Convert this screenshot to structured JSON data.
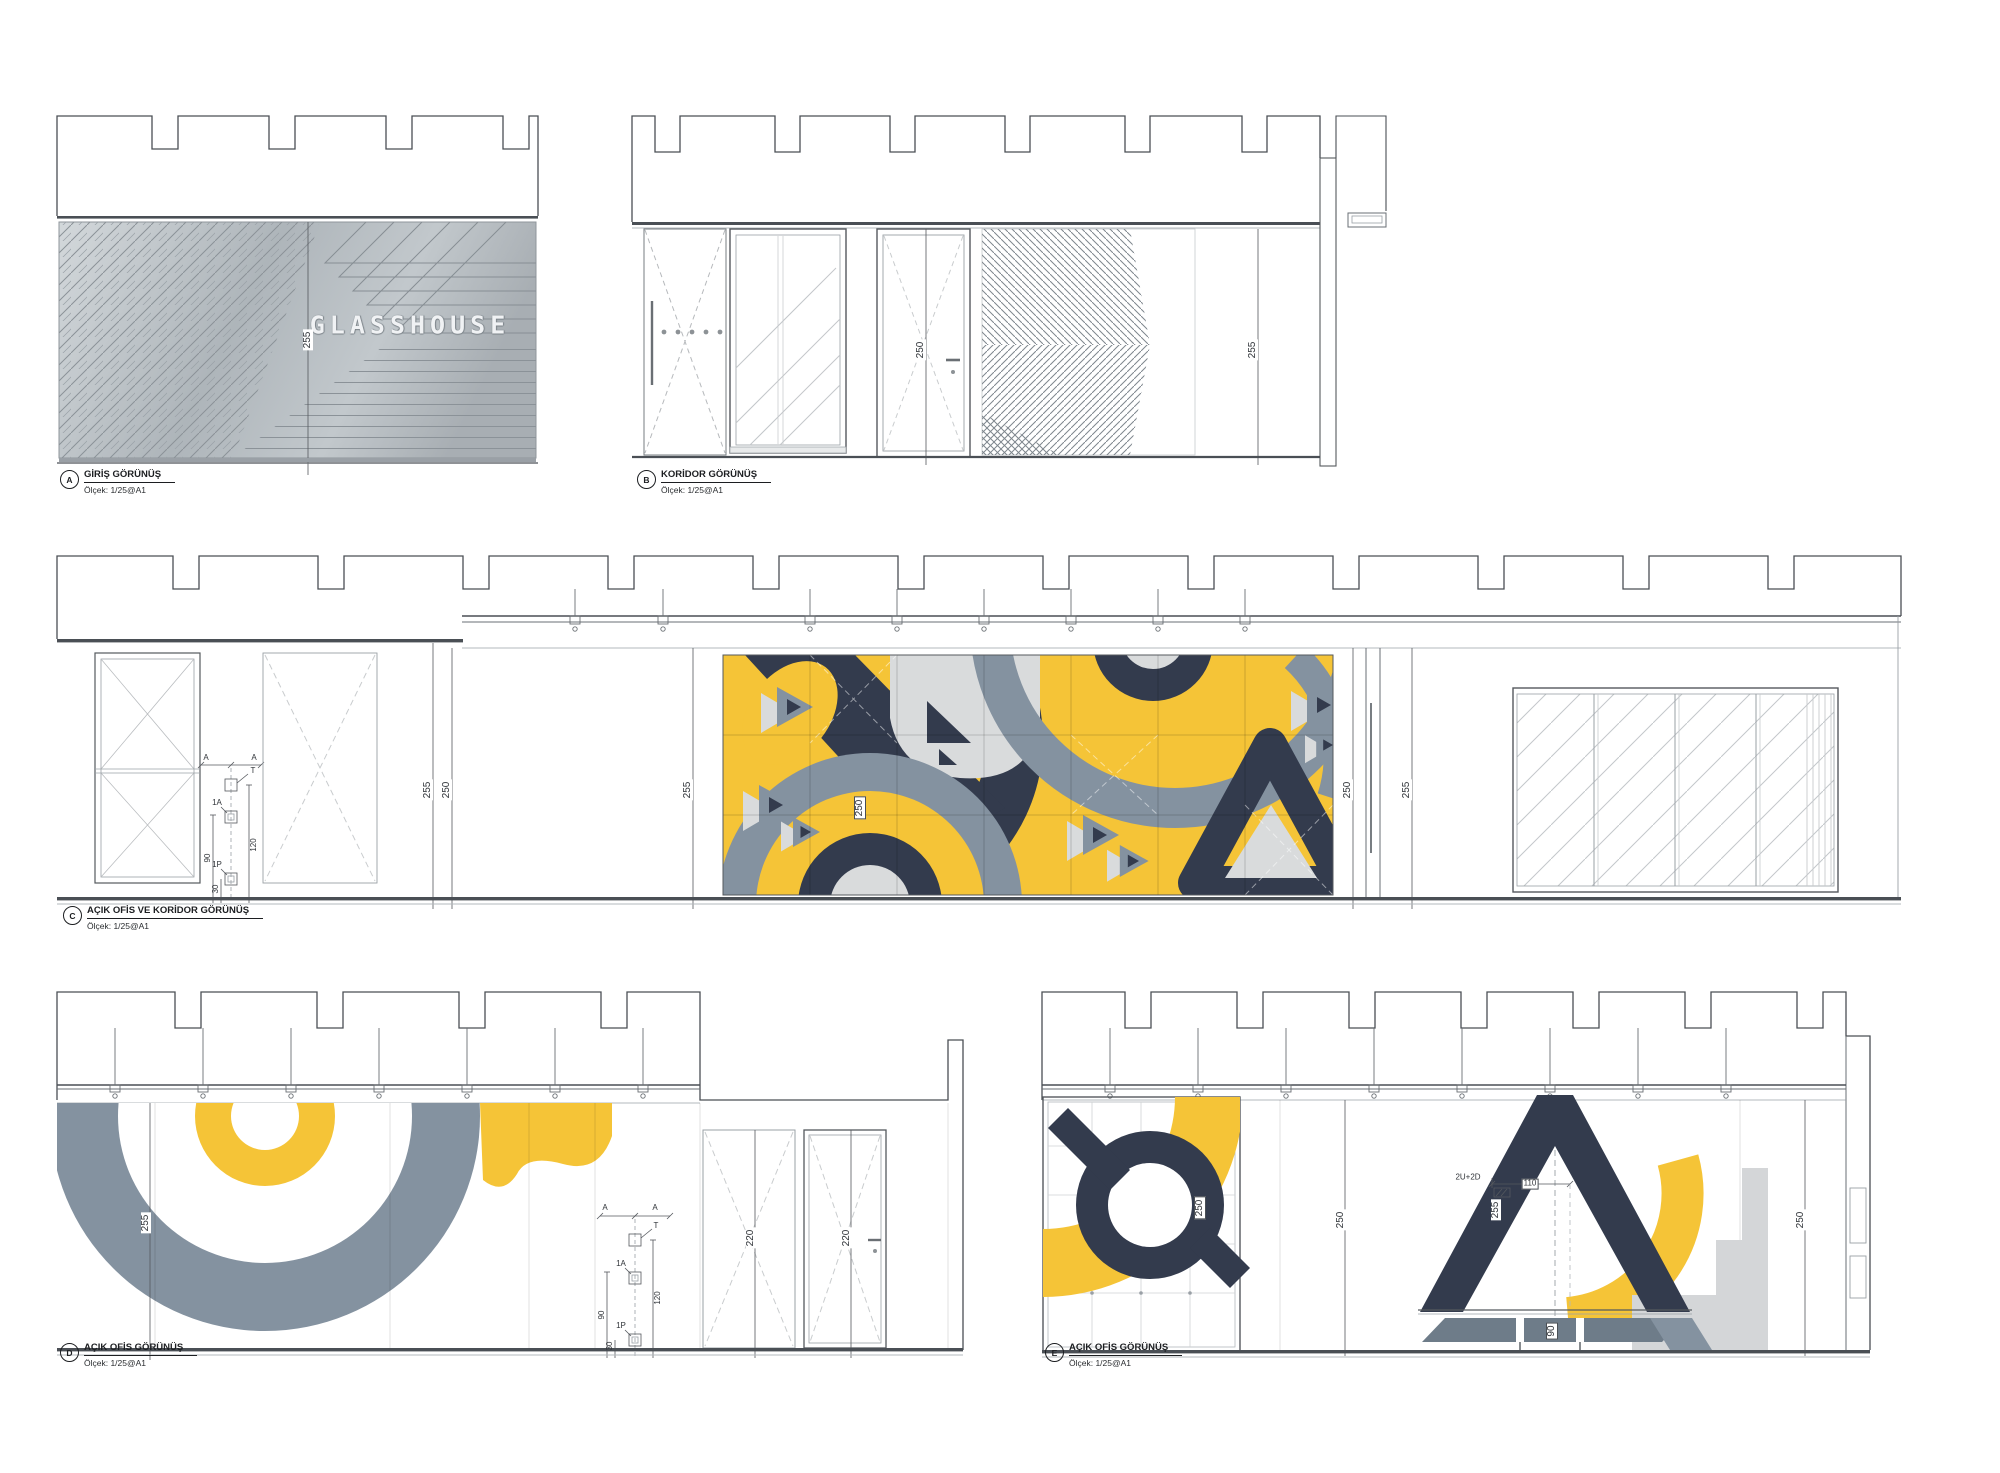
{
  "colors": {
    "yellow": "#F5C437",
    "navy": "#333B4D",
    "slate": "#8492A0",
    "light_gray": "#D9DBDC",
    "silver": "#B9C0C5",
    "line": "#4A4F55"
  },
  "callout": {
    "a": "A",
    "t": "T",
    "r1a": "1A",
    "r1p": "1P",
    "d120": "120",
    "d90": "90",
    "d30": "30"
  },
  "drawings": {
    "a": {
      "ref": "A",
      "title": "GİRİŞ GÖRÜNÜŞ",
      "scale": "Ölçek: 1/25@A1",
      "sign": "GLASSHOUSE",
      "dim_wall": "255"
    },
    "b": {
      "ref": "B",
      "title": "KORİDOR GÖRÜNÜŞ",
      "scale": "Ölçek: 1/25@A1",
      "dim_door": "250",
      "dim_wall": "255"
    },
    "c": {
      "ref": "C",
      "title": "AÇIK OFİS VE KORİDOR GÖRÜNÜŞ",
      "scale": "Ölçek: 1/25@A1",
      "dim_1": "255",
      "dim_2": "250",
      "dim_3": "255",
      "dim_mural": "250",
      "dim_4": "250",
      "dim_5": "255"
    },
    "d": {
      "ref": "D",
      "title": "AÇIK OFİS GÖRÜNÜŞ",
      "scale": "Ölçek: 1/25@A1",
      "dim_wall": "255",
      "dim_door1": "220",
      "dim_door2": "220"
    },
    "e": {
      "ref": "E",
      "title": "AÇIK OFİS GÖRÜNÜŞ",
      "scale": "Ölçek: 1/25@A1",
      "dim_q": "250",
      "dim_mid": "250",
      "dim_a_leg": "255",
      "dim_right": "250",
      "dim_table_w": "110",
      "dim_table_h": "90",
      "fix_note": "2U+2D"
    }
  }
}
